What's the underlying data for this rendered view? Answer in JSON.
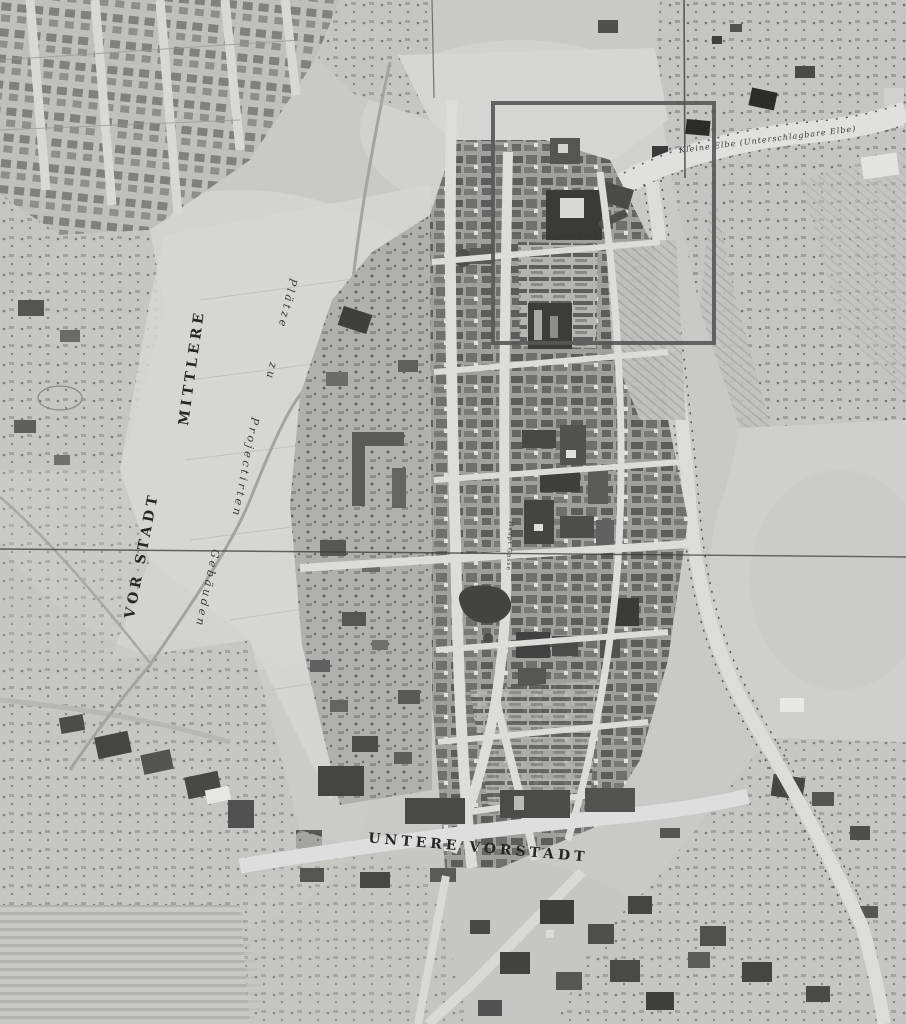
{
  "map": {
    "type": "historical-city-map-scan",
    "labels": {
      "mittlere": "MITTLERE",
      "vorstadt": "VOR STADT",
      "plaetze": "Plätze",
      "zu": "zu",
      "projectirten": "Projectirten",
      "gebaeuden": "Gebäuden",
      "untere_vorstadt": "UNTERE VORSTADT",
      "river": "Kleine Elbe (Unterschlagbare Elbe)",
      "exerzier_platz": "Exerzier Platz",
      "haupt_gasse": "Haupt Gasse"
    },
    "palette": {
      "paper": "#c9c9c7",
      "open_field": "#d6d6d4",
      "street": "#dcdcda",
      "building_dark": "#3c3c3a",
      "building_mid": "#6a6a68",
      "ink": "#2a2a2a",
      "selection_stroke": "#575757",
      "fold_line": "#3a3a3a"
    },
    "overlay": {
      "selection_box": {
        "x": 493,
        "y": 103,
        "width": 221,
        "height": 240
      }
    }
  }
}
